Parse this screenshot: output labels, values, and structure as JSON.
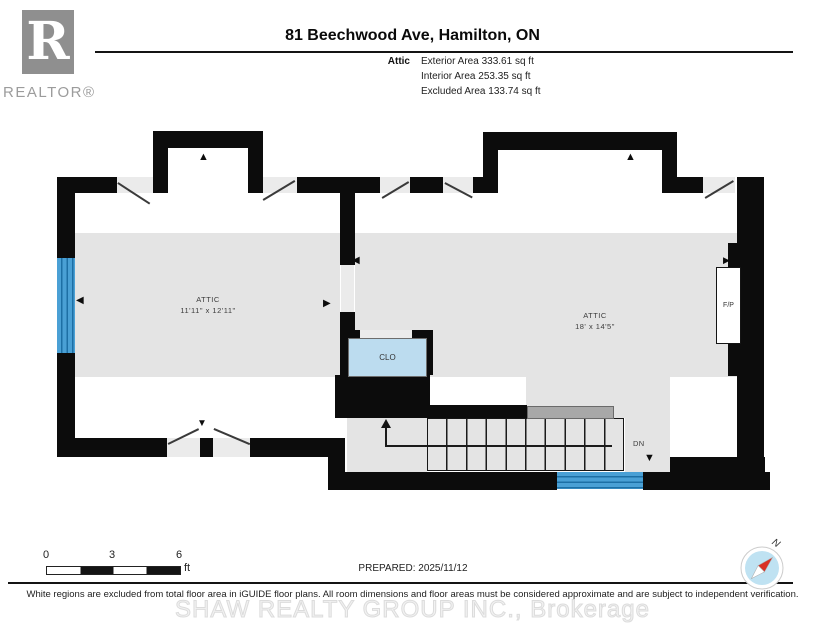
{
  "header": {
    "logo_letter": "R",
    "logo_text": "REALTOR®",
    "title": "81 Beechwood Ave, Hamilton, ON",
    "floor_label": "Attic",
    "areas": [
      "Exterior Area 333.61 sq ft",
      "Interior Area 253.35 sq ft",
      "Excluded Area 133.74 sq ft"
    ]
  },
  "plan": {
    "rooms": [
      {
        "name": "ATTIC",
        "dims": "11'11\" x 12'11\""
      },
      {
        "name": "ATTIC",
        "dims": "18' x 14'5\""
      }
    ],
    "labels": {
      "closet": "CLO",
      "fireplace": "F/P",
      "down": "DN"
    }
  },
  "icons": {
    "up": "▲",
    "down": "▼",
    "left": "◀",
    "right": "▶"
  },
  "footer": {
    "scale_ticks": [
      "0",
      "3",
      "6"
    ],
    "scale_unit": "ft",
    "prepared": "PREPARED: 2025/11/12",
    "compass_n": "N",
    "disclaimer": "White regions are excluded from total floor area in iGUIDE floor plans. All room dimensions and floor areas must be considered approximate and are subject to independent verification.",
    "watermark": "SHAW REALTY GROUP INC., Brokerage"
  },
  "colors": {
    "wall": "#0c0c0c",
    "excluded_floor_gray": "#e4e4e4",
    "window_blue": "#4aa0d5",
    "closet_blue": "#bcdcef",
    "handrail_gray": "#a8a8a8",
    "compass_blue": "#bfe2f2",
    "needle_red": "#d93025"
  }
}
